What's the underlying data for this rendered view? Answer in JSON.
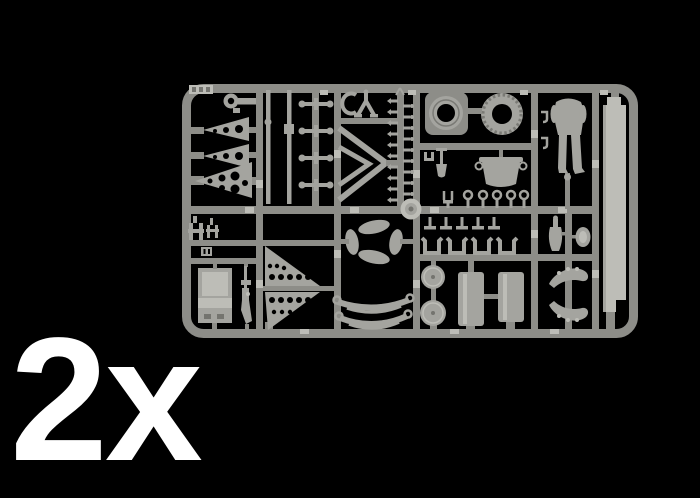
{
  "label": {
    "quantity": "2x"
  },
  "colors": {
    "background": "#000000",
    "label_text": "#ffffff",
    "sprue_runner": "#8d8d88",
    "sprue_part": "#a4a49f",
    "sprue_part_light": "#bdbdb7",
    "sprue_part_dark": "#74746f",
    "tire_tread": "#7a7a75"
  },
  "sprue": {
    "name": "injection-molded-parts-sprue",
    "parts_visible": [
      "corner-tag",
      "wrench",
      "cone-horn-small",
      "cone-horn-medium",
      "cone-horn-large",
      "thin-rod",
      "thin-rod-with-collar",
      "axle-crosses",
      "c-clamp",
      "tow-fork",
      "chevron-frames",
      "pin-ladder",
      "road-wheel-with-plate",
      "treaded-tire",
      "shovel",
      "cooking-pot",
      "eyelet-rings",
      "center-hub",
      "soldier-figure-legs",
      "long-plank",
      "small-clamps",
      "seat",
      "rifle",
      "perforated-triangle-plates",
      "pinwheel-curved-parts",
      "leaf-springs",
      "t-hooks",
      "u-brackets",
      "road-wheel-pair",
      "oil-drum-pair",
      "water-bottle",
      "canteen",
      "rolled-tarps"
    ]
  }
}
